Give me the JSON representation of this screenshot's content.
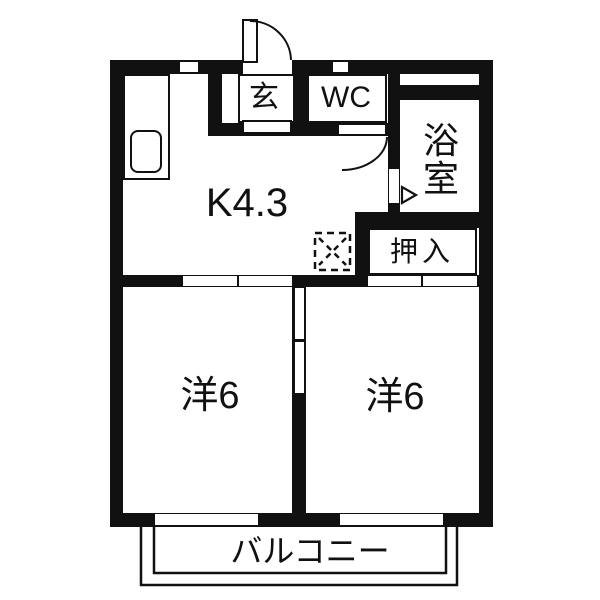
{
  "figure": {
    "type": "floor-plan",
    "style": "japanese-real-estate",
    "colors": {
      "wall": "#111111",
      "floor": "#ffffff",
      "line": "#111111"
    }
  },
  "rooms": {
    "kitchen": {
      "label": "K4.3"
    },
    "entrance": {
      "label": "玄"
    },
    "toilet": {
      "label": "WC"
    },
    "bath": {
      "label": "浴室",
      "chars": [
        "浴",
        "室"
      ]
    },
    "closet": {
      "label": "押入"
    },
    "bedroom_left": {
      "label": "洋6"
    },
    "bedroom_right": {
      "label": "洋6"
    },
    "balcony": {
      "label": "バルコニー"
    }
  },
  "fixtures": {
    "kitchen_counter": "counter",
    "kitchen_sink": "sink",
    "washing_machine_pan": "dashed-square-with-x",
    "entrance_door": "swing-door",
    "wc_door": "swing-door",
    "bath_door": "folding-door-with-arrow",
    "sliding_doors": [
      "kitchen-to-left-bedroom",
      "between-bedrooms",
      "closet-fusuma"
    ],
    "windows": [
      "kitchen-top",
      "wc-top",
      "bath-top-band",
      "left-bedroom-balcony",
      "right-bedroom-balcony"
    ]
  }
}
